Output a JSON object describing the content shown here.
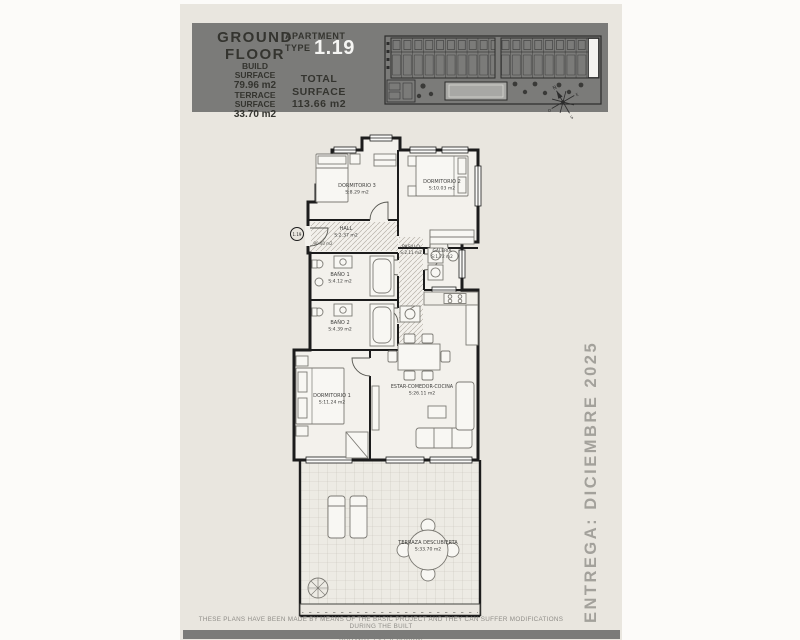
{
  "header": {
    "title_line1": "GROUND",
    "title_line2": "FLOOR",
    "build_surface_label1": "BUILD",
    "build_surface_label2": "SURFACE",
    "build_surface_value": "79.96 m2",
    "terrace_surface_label1": "TERRACE",
    "terrace_surface_label2": "SURFACE",
    "terrace_surface_value": "33.70 m2",
    "apartment_label1": "APARTMENT",
    "apartment_label2": "TYPE",
    "apartment_number": "1.19",
    "total_surface_label1": "TOTAL",
    "total_surface_label2": "SURFACE",
    "total_surface_value": "113.66 m2"
  },
  "site_plan": {
    "compass": {
      "n": "N",
      "e": "E",
      "s": "S",
      "o": "O"
    }
  },
  "floor_plan": {
    "unit_marker": "1.19",
    "entry_note": "90.40 m2",
    "rooms": {
      "dormitorio3": {
        "name": "DORMITORIO 3",
        "area": "S:8.29 m2"
      },
      "dormitorio2": {
        "name": "DORMITORIO 2",
        "area": "S:10.03 m2"
      },
      "hall": {
        "name": "HALL",
        "area": "S:2.37 m2"
      },
      "pasillo": {
        "name": "PASILLO",
        "area": "S:2.11 m2"
      },
      "galeria": {
        "name": "GALERIA",
        "area": "S:1.72 m2"
      },
      "bano1": {
        "name": "BAÑO 1",
        "area": "S:4.12 m2"
      },
      "bano2": {
        "name": "BAÑO 2",
        "area": "S:4.39 m2"
      },
      "dormitorio1": {
        "name": "DORMITORIO 1",
        "area": "S:11.24 m2"
      },
      "estar": {
        "name": "ESTAR-COMEDOR-COCINA",
        "area": "S:26.11 m2"
      },
      "terraza": {
        "name": "TERRAZA DESCUBIERTA",
        "area": "S:33.70 m2"
      }
    }
  },
  "delivery_note": "ENTREGA: DICIEMBRE 2025",
  "footer": {
    "line1": "THESE PLANS HAVE BEEN MADE BY MEANS OF THE BASIC PROJECT AND THEY CAN SUFFER MODIFICATIONS DURING THE BUILT",
    "line2": "ESTOS PLANOS HAN SIDO REALIZADOS EN BASE AL PROYECTO BASICO, PUDIENDO SUFRIR MODIFICACIONES DURANTE LA EJECUCION"
  },
  "colors": {
    "header_bg": "#7b7b79",
    "paper": "#e9e6df",
    "apartment_number_color": "#f5f5f3",
    "ink": "#1c1c1c",
    "muted_text": "#a3a19b"
  }
}
